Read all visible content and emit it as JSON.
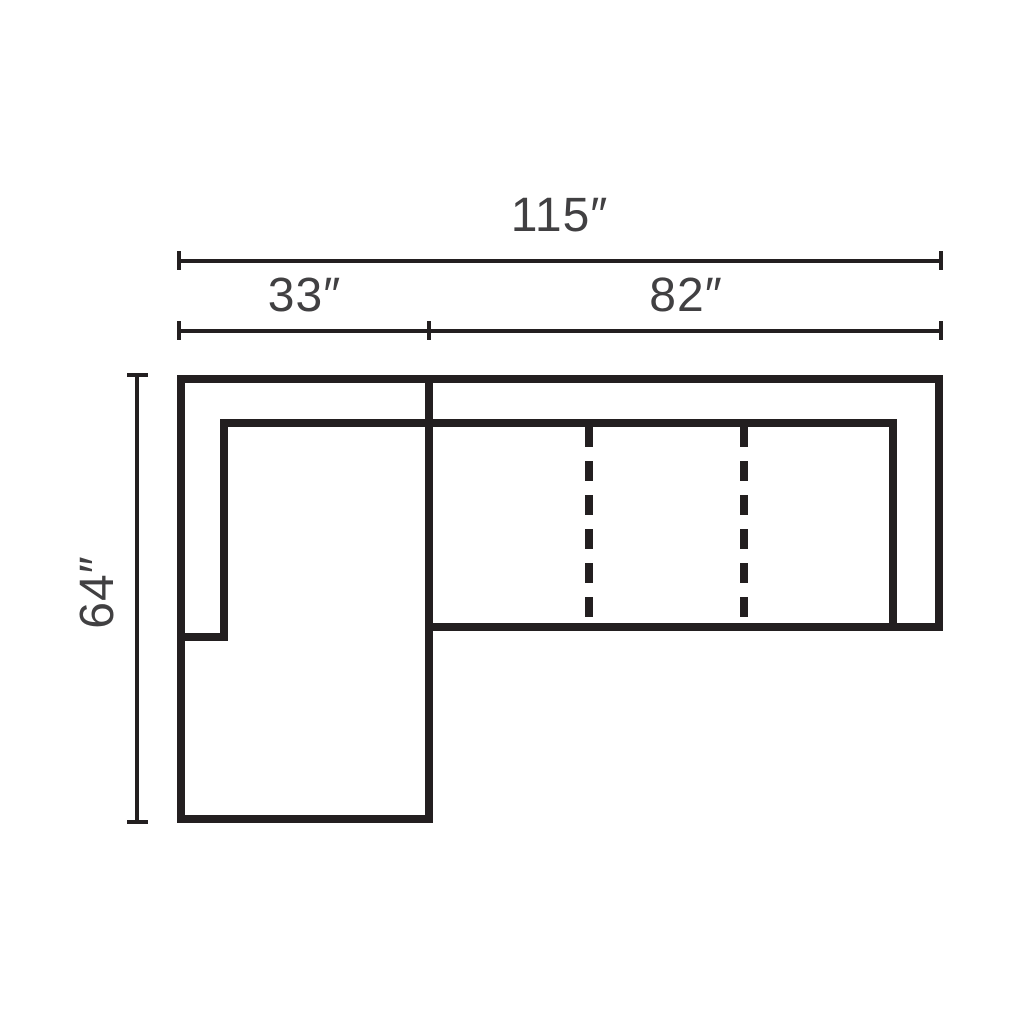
{
  "figure": {
    "kind": "sectional-sofa-dimension-diagram",
    "colors": {
      "ink": "#231f20",
      "text": "#414042",
      "bg": "#ffffff"
    },
    "dimensions": {
      "overall_width": {
        "label": "115″",
        "value": 115,
        "unit": "inches"
      },
      "chaise_width": {
        "label": "33″",
        "value": 33,
        "unit": "inches"
      },
      "seat_section_width": {
        "label": "82″",
        "value": 82,
        "unit": "inches"
      },
      "overall_depth": {
        "label": "64″",
        "value": 64,
        "unit": "inches"
      }
    }
  }
}
